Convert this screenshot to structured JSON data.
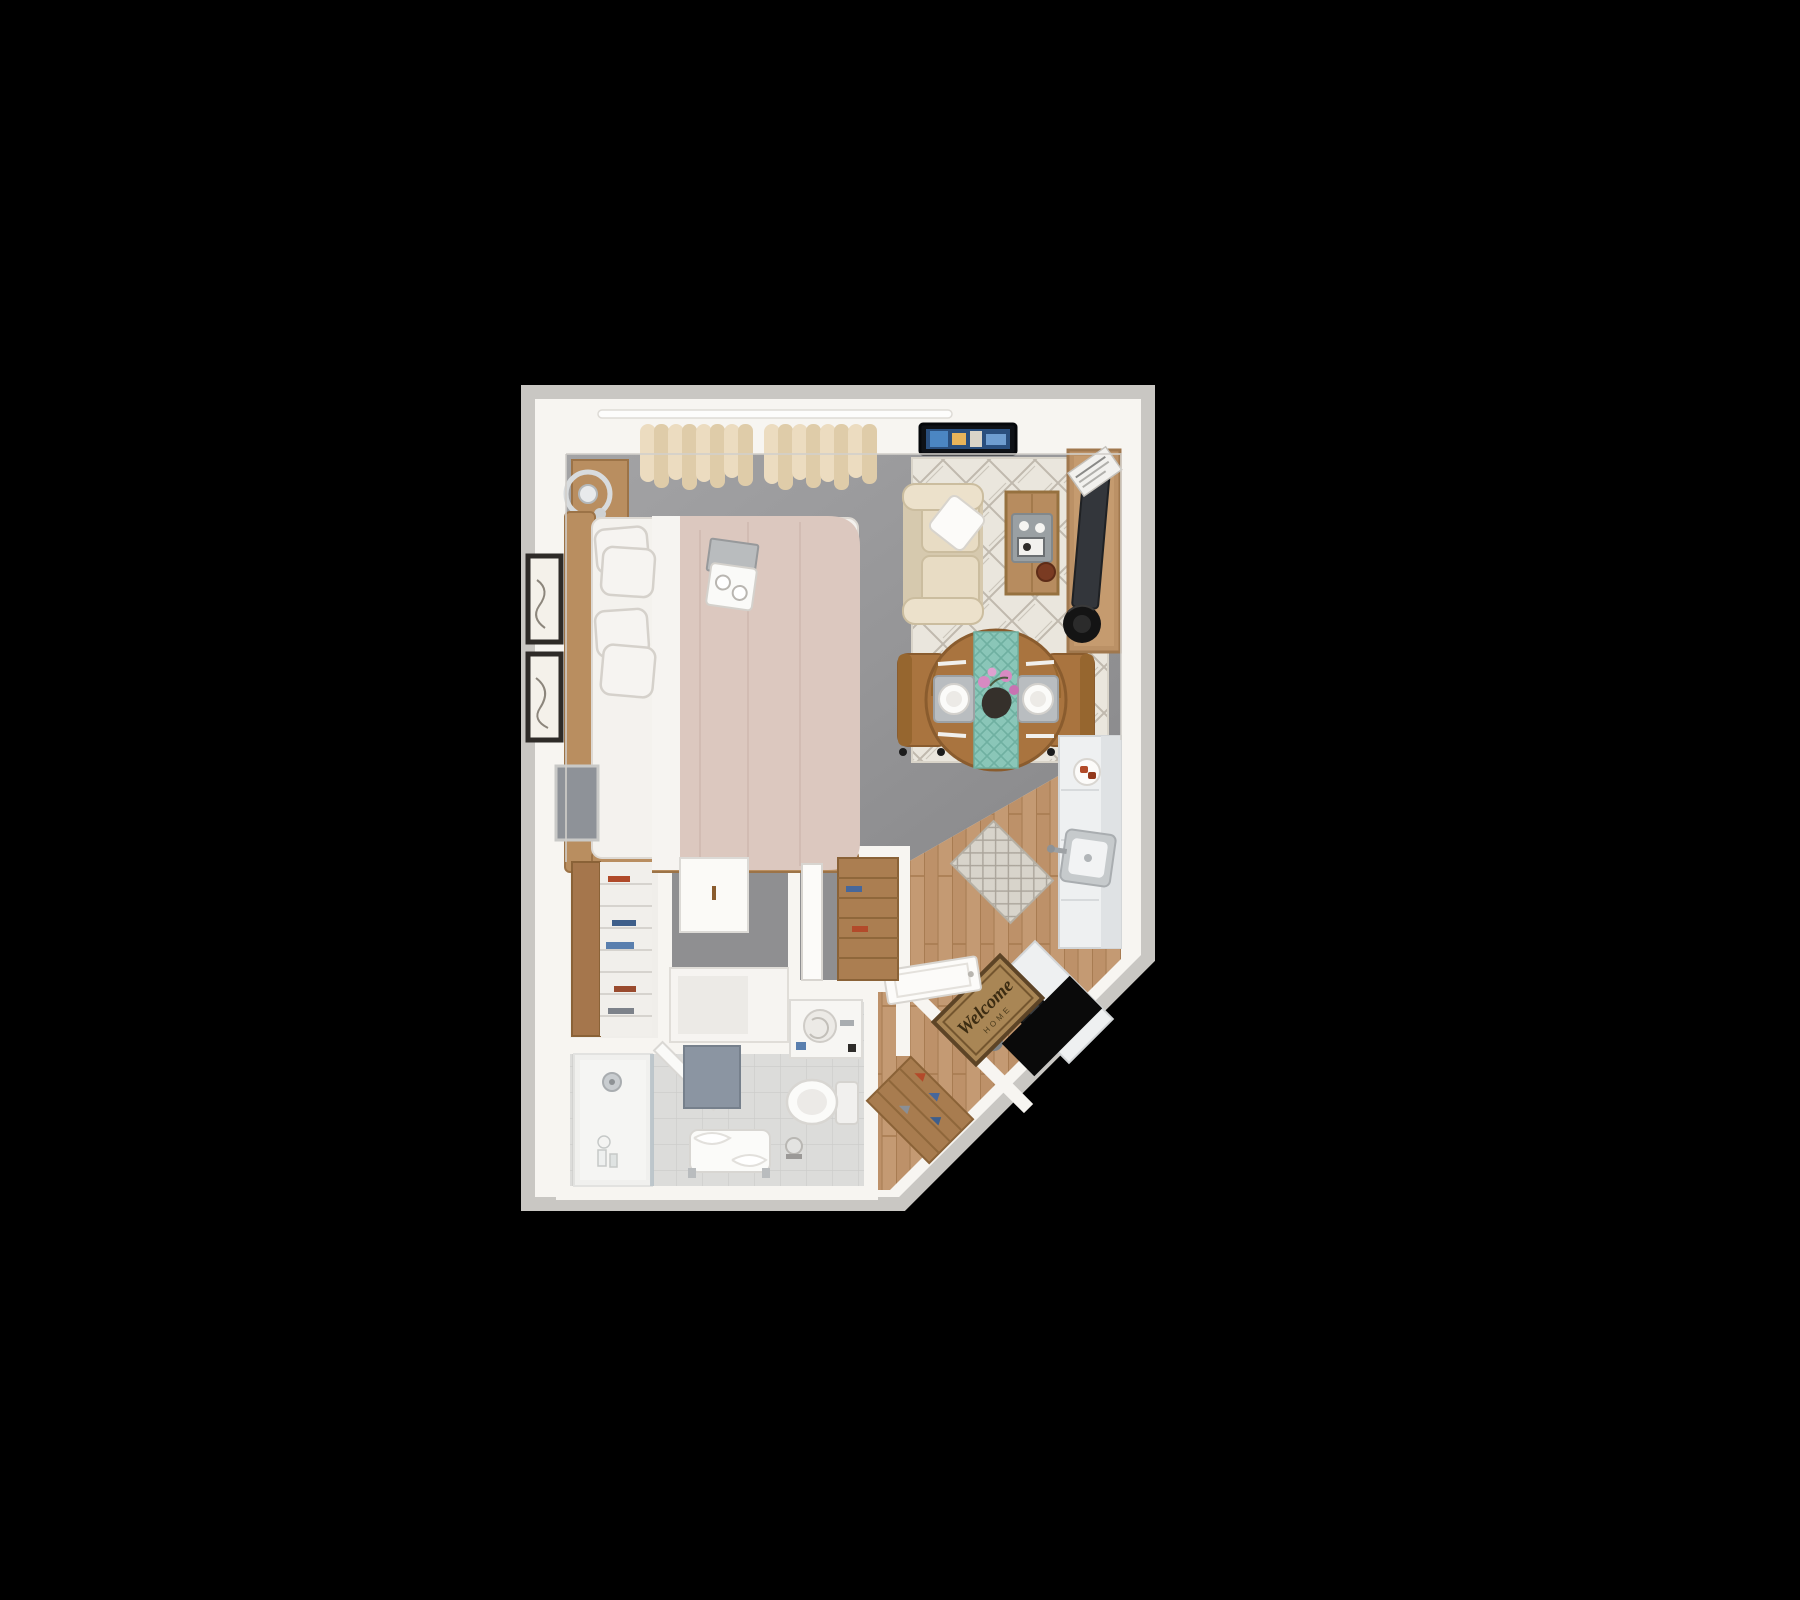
{
  "scene": {
    "kind": "3d-floorplan-top-view",
    "description": "Studio apartment 3D floor plan on black background",
    "background": "#000000"
  },
  "entry_mat": {
    "line1": "Welcome",
    "line2": "HOME"
  },
  "palette": {
    "background": "#000000",
    "wall": "#f7f5f1",
    "wall_trim": "#c9c7c3",
    "carpet": "#949496",
    "wood_floor": "#c49a73",
    "bath_tile": "#dcdcda",
    "shower_floor": "#f0f0ee",
    "living_rug": "#eae6dd",
    "kitchen_counter": "#eef0f1",
    "sofa": "#e2d6bd",
    "bed_duvet": "#dcc8bf",
    "bed_linen": "#f4f2ee",
    "wood_furniture": "#b98e60",
    "dining_table": "#a9743f",
    "runner_teal": "#8ac6b8",
    "orchid_pink": "#d78ac2",
    "door_mat": "#a98655",
    "open_door": "#0a0a0a",
    "bath_mat": "#8b95a2",
    "tv_screen": "#2a4f7e"
  },
  "areas": {
    "bedroom": "bedroom",
    "living": "living-area",
    "dining": "dining-area",
    "kitchen": "kitchen",
    "bathroom": "bathroom",
    "entry": "entry",
    "closets": "closets"
  }
}
